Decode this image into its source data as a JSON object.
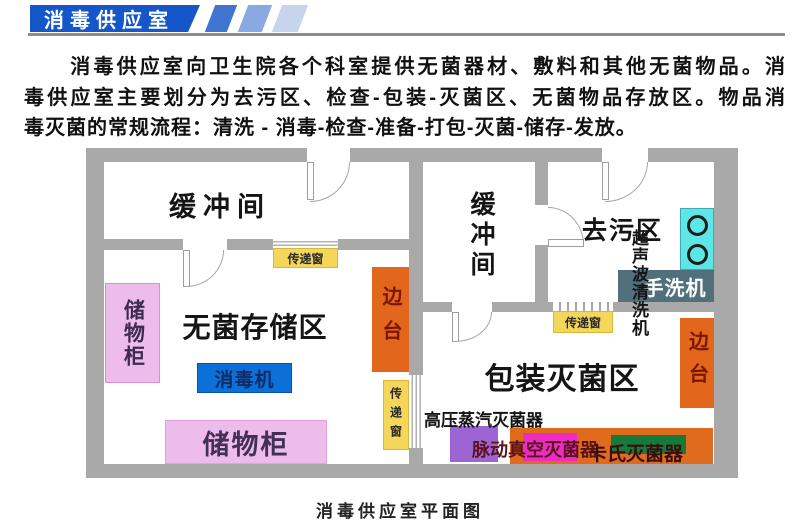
{
  "header": {
    "title": "消毒供应室",
    "banner_color": "#1557c9",
    "stripe_colors": [
      "#3f74cf",
      "#8aa9e0",
      "#c7d4ee"
    ],
    "rule_color": "#8c8c8c"
  },
  "intro": {
    "lines": [
      "　　消毒供应室向卫生院各个科室提供无菌器材、敷料和其他无菌物品。消",
      "毒供应室主要划分为去污区、检查-包装-灭菌区、无菌物品存放区。物品消",
      "毒灭菌的常规流程：清洗 - 消毒-检查-准备-打包-灭菌-储存-发放。"
    ]
  },
  "colors": {
    "wall": "#a9a9a9",
    "transfer_window_yellow": "#f3d65a",
    "cabinet_pink": "#eebcec",
    "sidetable_orange": "#e2661c",
    "disinfector_blue": "#0b70d8",
    "ultrasonic_cyan": "#5ce6e6",
    "handwash_slate": "#51707c",
    "autoclave_purple": "#9d64d4",
    "pulse_magenta": "#ee2cc4",
    "cassette_green": "#157a3a",
    "band_orange": "#e06a1e"
  },
  "floorplan": {
    "caption": "消毒供应室平面图",
    "rooms": {
      "buffer_left": "缓冲间",
      "buffer_middle": "缓冲间",
      "decontamination": "去污区",
      "sterile_storage": "无菌存储区",
      "packing_sterilization": "包装灭菌区"
    },
    "equipment": {
      "cabinet_left": "储物柜",
      "cabinet_bottom": "储物柜",
      "sidetable_left": "边台",
      "sidetable_right": "边台",
      "disinfector": "消毒机",
      "ultrasonic_cleaner": "超声波清洗机",
      "handwash_machine": "手洗机",
      "autoclave": "高压蒸汽灭菌器",
      "pulse_vacuum_sterilizer": "脉动真空灭菌器",
      "cassette_sterilizer": "卡氏灭菌器",
      "transfer_window_1": "传递窗",
      "transfer_window_2": "传递窗",
      "transfer_window_3": "传递窗"
    }
  }
}
